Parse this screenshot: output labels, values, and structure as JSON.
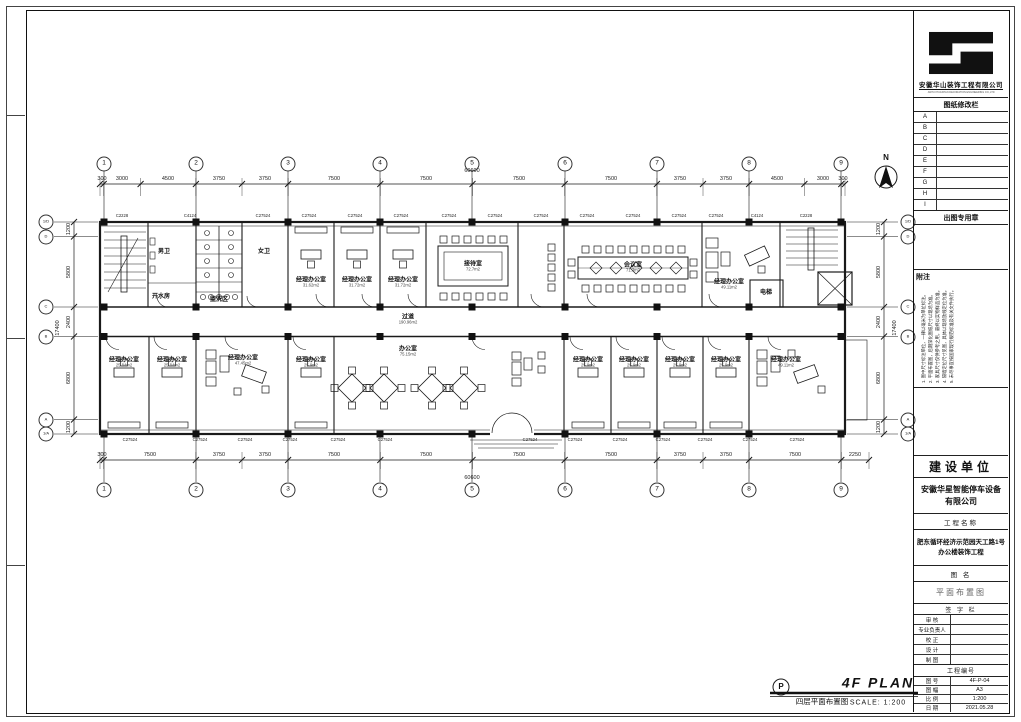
{
  "sheet": {
    "company": "安徽华山装饰工程有限公司",
    "company_en": "ANHUI HUASHAN DECORATION ENGINEERING CO.,LTD",
    "revision_title": "图纸修改栏",
    "revision_rows": [
      "A",
      "B",
      "C",
      "D",
      "E",
      "F",
      "G",
      "H",
      "I"
    ],
    "stamp_label": "出图专用章",
    "notes_label": "附注",
    "notes": [
      "1. 图中尺寸标注单位，一律以毫米为单位标注。",
      "2. 平面布置图，后期深化图纸尺寸以现场为准。",
      "3. 家具尺寸仅供参考之用，最终以实物样品为准。",
      "4. 隔墙定位尺寸见图，具体以现场放线定位为准。",
      "5. 未尽事宜按国家现行规范标准及有关文件执行。"
    ],
    "owner_label": "建设单位",
    "owner_name": "安徽华星智能停车设备有限公司",
    "project_label": "工程名称",
    "project_name": "肥东循环经济示范园天工路1号办公楼装饰工程",
    "drawing_name_label": "图  名",
    "drawing_name": "平面布置图",
    "sign_label": "签 字 栏",
    "sign_rows": [
      {
        "label": "审  核",
        "value": ""
      },
      {
        "label": "专业负责人",
        "value": ""
      },
      {
        "label": "校  正",
        "value": ""
      },
      {
        "label": "设  计",
        "value": ""
      },
      {
        "label": "制  图",
        "value": ""
      }
    ],
    "project_no_label": "工程编号",
    "info_rows": [
      {
        "label": "图  号",
        "value": "4F-P-04"
      },
      {
        "label": "图  幅",
        "value": "A3"
      },
      {
        "label": "比  例",
        "value": "1:200"
      },
      {
        "label": "日  期",
        "value": "2021.05.28"
      }
    ]
  },
  "plan": {
    "title_cn": "四层平面布置图",
    "title_en": "4F PLAN",
    "scale_label": "SCALE:  1:200",
    "marker_letter": "P",
    "north_label": "N",
    "total_h": "60600",
    "total_v": "17400",
    "grid_top": [
      {
        "n": "1",
        "x": 104
      },
      {
        "n": "2",
        "x": 196
      },
      {
        "n": "3",
        "x": 288
      },
      {
        "n": "4",
        "x": 380
      },
      {
        "n": "5",
        "x": 472
      },
      {
        "n": "6",
        "x": 565
      },
      {
        "n": "7",
        "x": 657
      },
      {
        "n": "8",
        "x": 749
      },
      {
        "n": "9",
        "x": 841
      }
    ],
    "grid_bottom": [
      {
        "n": "1",
        "x": 104
      },
      {
        "n": "2",
        "x": 196
      },
      {
        "n": "3",
        "x": 288
      },
      {
        "n": "4",
        "x": 380
      },
      {
        "n": "5",
        "x": 472
      },
      {
        "n": "6",
        "x": 565
      },
      {
        "n": "7",
        "x": 657
      },
      {
        "n": "8",
        "x": 749
      },
      {
        "n": "9",
        "x": 841
      }
    ],
    "rows_left": [
      {
        "n": "1/D",
        "y": 222
      },
      {
        "n": "D",
        "y": 236.5
      },
      {
        "n": "C",
        "y": 307
      },
      {
        "n": "B",
        "y": 336.5
      },
      {
        "n": "A",
        "y": 419.5
      },
      {
        "n": "1/A",
        "y": 434
      }
    ],
    "rows_right": [
      {
        "n": "1/D",
        "y": 222
      },
      {
        "n": "D",
        "y": 236.5
      },
      {
        "n": "C",
        "y": 307
      },
      {
        "n": "B",
        "y": 336.5
      },
      {
        "n": "A",
        "y": 419.5
      },
      {
        "n": "1/A",
        "y": 434
      }
    ],
    "dims_top": [
      {
        "v": "300",
        "x": 102
      },
      {
        "v": "3000",
        "x": 122
      },
      {
        "v": "4500",
        "x": 168
      },
      {
        "v": "3750",
        "x": 219
      },
      {
        "v": "3750",
        "x": 265
      },
      {
        "v": "7500",
        "x": 334
      },
      {
        "v": "7500",
        "x": 426
      },
      {
        "v": "7500",
        "x": 519
      },
      {
        "v": "7500",
        "x": 611
      },
      {
        "v": "3750",
        "x": 680
      },
      {
        "v": "3750",
        "x": 726
      },
      {
        "v": "4500",
        "x": 777
      },
      {
        "v": "3000",
        "x": 823
      },
      {
        "v": "300",
        "x": 843
      }
    ],
    "dims_bottom": [
      {
        "v": "300",
        "x": 102
      },
      {
        "v": "7500",
        "x": 150
      },
      {
        "v": "3750",
        "x": 219
      },
      {
        "v": "3750",
        "x": 265
      },
      {
        "v": "7500",
        "x": 334
      },
      {
        "v": "7500",
        "x": 426
      },
      {
        "v": "7500",
        "x": 519
      },
      {
        "v": "7500",
        "x": 611
      },
      {
        "v": "3750",
        "x": 680
      },
      {
        "v": "3750",
        "x": 726
      },
      {
        "v": "7500",
        "x": 795
      },
      {
        "v": "2250",
        "x": 855
      }
    ],
    "dims_left": [
      {
        "v": "1200",
        "y": 229
      },
      {
        "v": "5800",
        "y": 272
      },
      {
        "v": "2400",
        "y": 322
      },
      {
        "v": "6800",
        "y": 378
      },
      {
        "v": "1200",
        "y": 427
      }
    ],
    "dims_right": [
      {
        "v": "1200",
        "y": 229
      },
      {
        "v": "5800",
        "y": 272
      },
      {
        "v": "2400",
        "y": 322
      },
      {
        "v": "6800",
        "y": 378
      },
      {
        "v": "1200",
        "y": 427
      }
    ],
    "windows_top": [
      {
        "c": "C2228",
        "x": 122
      },
      {
        "c": "C4124",
        "x": 190
      },
      {
        "c": "C27524",
        "x": 263
      },
      {
        "c": "C27524",
        "x": 309
      },
      {
        "c": "C27524",
        "x": 355
      },
      {
        "c": "C27524",
        "x": 401
      },
      {
        "c": "C27524",
        "x": 449
      },
      {
        "c": "C27524",
        "x": 495
      },
      {
        "c": "C27524",
        "x": 541
      },
      {
        "c": "C27524",
        "x": 587
      },
      {
        "c": "C27524",
        "x": 633
      },
      {
        "c": "C27524",
        "x": 679
      },
      {
        "c": "C27524",
        "x": 716
      },
      {
        "c": "C4124",
        "x": 757
      },
      {
        "c": "C2228",
        "x": 806
      }
    ],
    "windows_bottom": [
      {
        "c": "C27524",
        "x": 130
      },
      {
        "c": "C27524",
        "x": 200
      },
      {
        "c": "C27524",
        "x": 245
      },
      {
        "c": "C27524",
        "x": 290
      },
      {
        "c": "C27524",
        "x": 338
      },
      {
        "c": "C27524",
        "x": 385
      },
      {
        "c": "C27524",
        "x": 530
      },
      {
        "c": "C27524",
        "x": 575
      },
      {
        "c": "C27524",
        "x": 620
      },
      {
        "c": "C27524",
        "x": 663
      },
      {
        "c": "C27524",
        "x": 705
      },
      {
        "c": "C27524",
        "x": 750
      },
      {
        "c": "C27524",
        "x": 797
      }
    ],
    "rooms": [
      {
        "name": "男卫",
        "area": "",
        "x": 164,
        "y": 252
      },
      {
        "name": "女卫",
        "area": "",
        "x": 264,
        "y": 252
      },
      {
        "name": "盥洗区",
        "area": "",
        "x": 219,
        "y": 300
      },
      {
        "name": "开水房",
        "area": "",
        "x": 161,
        "y": 297
      },
      {
        "name": "经理办公室",
        "area": "31.62m2",
        "x": 311,
        "y": 283
      },
      {
        "name": "经理办公室",
        "area": "31.72m2",
        "x": 357,
        "y": 283
      },
      {
        "name": "经理办公室",
        "area": "31.72m2",
        "x": 403,
        "y": 283
      },
      {
        "name": "接待室",
        "area": "72.7m2",
        "x": 473,
        "y": 267
      },
      {
        "name": "会议室",
        "area": "71.3m2",
        "x": 633,
        "y": 268
      },
      {
        "name": "经理办公室",
        "area": "49.11m2",
        "x": 729,
        "y": 285
      },
      {
        "name": "电梯",
        "area": "",
        "x": 766,
        "y": 293
      },
      {
        "name": "过道",
        "area": "190.96m2",
        "x": 408,
        "y": 320
      },
      {
        "name": "办公室",
        "area": "75.15m2",
        "x": 408,
        "y": 352
      },
      {
        "name": "经理办公室",
        "area": "25.84m2",
        "x": 124,
        "y": 363
      },
      {
        "name": "经理办公室",
        "area": "25.84m2",
        "x": 172,
        "y": 363
      },
      {
        "name": "经理办公室",
        "area": "47.45m2",
        "x": 243,
        "y": 361
      },
      {
        "name": "经理办公室",
        "area": "25.9m2",
        "x": 311,
        "y": 363
      },
      {
        "name": "经理办公室",
        "area": "25.9m2",
        "x": 588,
        "y": 363
      },
      {
        "name": "经理办公室",
        "area": "25.9m2",
        "x": 634,
        "y": 363
      },
      {
        "name": "经理办公室",
        "area": "25.9m2",
        "x": 680,
        "y": 363
      },
      {
        "name": "经理办公室",
        "area": "25.9m2",
        "x": 726,
        "y": 363
      },
      {
        "name": "经理办公室",
        "area": "49.11m2",
        "x": 786,
        "y": 363
      }
    ]
  }
}
